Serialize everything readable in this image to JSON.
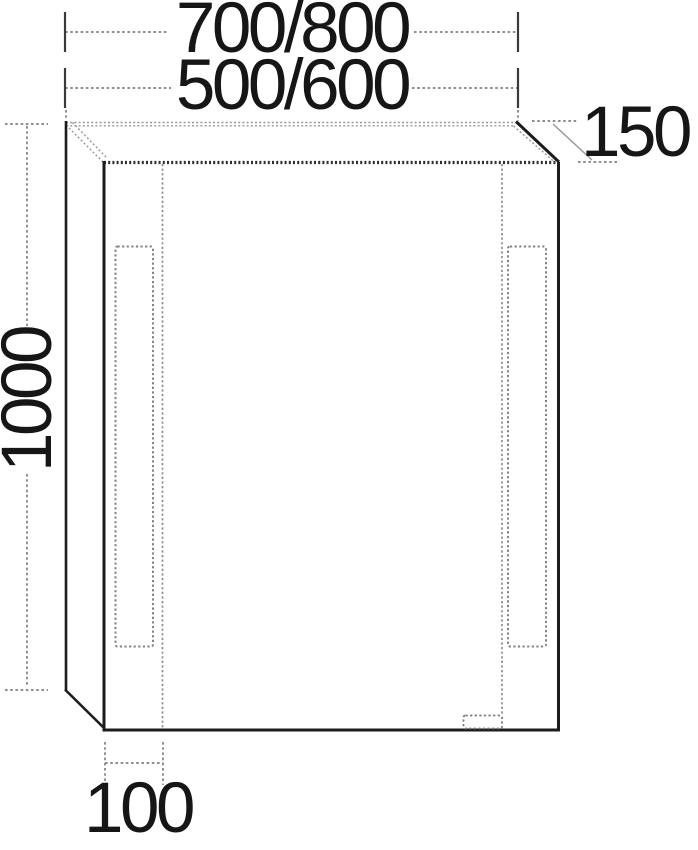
{
  "labels": {
    "top_width": "700/800",
    "inner_width": "500/600",
    "height": "1000",
    "depth": "150",
    "offset": "100"
  },
  "colors": {
    "solid_line": "#1c1c1c",
    "dashed_line": "#8f8f8f",
    "text": "#161616",
    "background": "#ffffff"
  }
}
